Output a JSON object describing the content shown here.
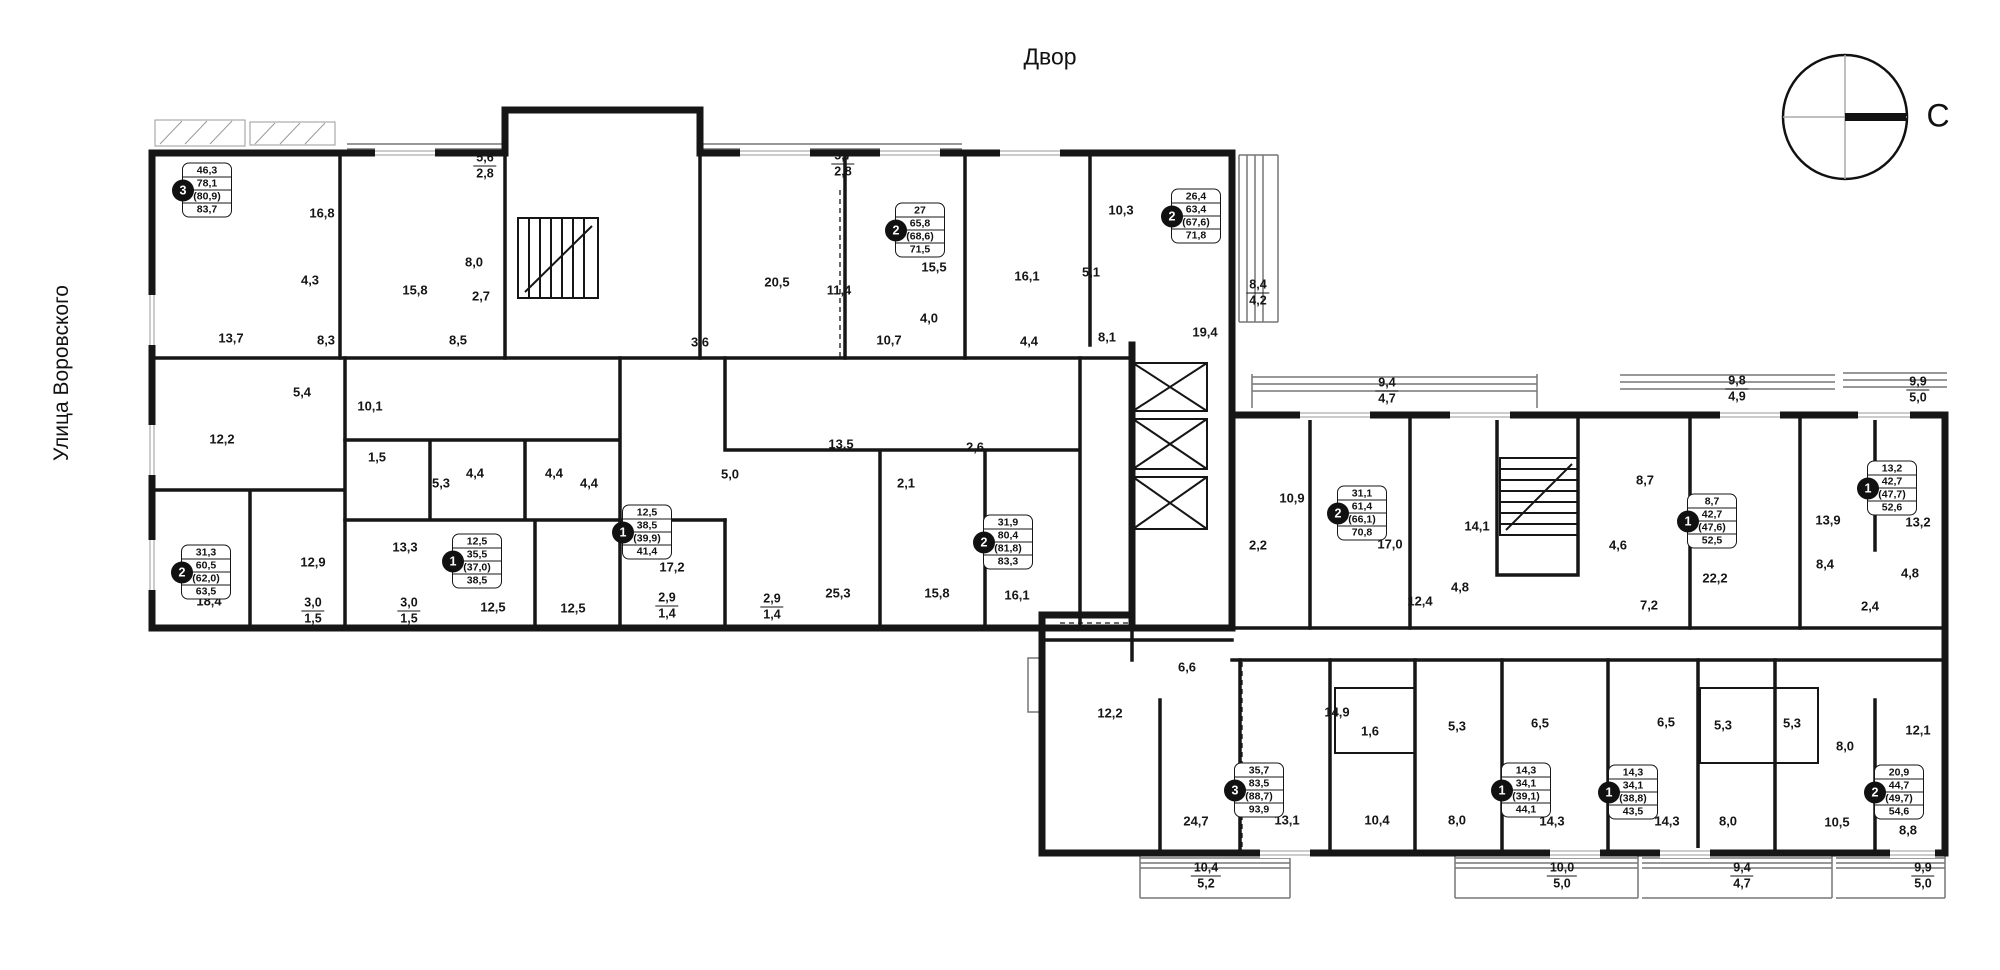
{
  "page": {
    "title": "Двор",
    "street": "Улица Воровского",
    "compass_letter": "С"
  },
  "apartments": [
    {
      "rooms": "3",
      "values": [
        "46,3",
        "78,1",
        "(80,9)",
        "83,7"
      ],
      "x": 207,
      "y": 190
    },
    {
      "rooms": "2",
      "values": [
        "27",
        "65,8",
        "(68,6)",
        "71,5"
      ],
      "x": 920,
      "y": 230
    },
    {
      "rooms": "2",
      "values": [
        "26,4",
        "63,4",
        "(67,6)",
        "71,8"
      ],
      "x": 1196,
      "y": 216
    },
    {
      "rooms": "2",
      "values": [
        "31,3",
        "60,5",
        "(62,0)",
        "63,5"
      ],
      "x": 206,
      "y": 572
    },
    {
      "rooms": "1",
      "values": [
        "12,5",
        "35,5",
        "(37,0)",
        "38,5"
      ],
      "x": 477,
      "y": 561
    },
    {
      "rooms": "1",
      "values": [
        "12,5",
        "38,5",
        "(39,9)",
        "41,4"
      ],
      "x": 647,
      "y": 532
    },
    {
      "rooms": "2",
      "values": [
        "31,9",
        "80,4",
        "(81,8)",
        "83,3"
      ],
      "x": 1008,
      "y": 542
    },
    {
      "rooms": "2",
      "values": [
        "31,1",
        "61,4",
        "(66,1)",
        "70,8"
      ],
      "x": 1362,
      "y": 513
    },
    {
      "rooms": "1",
      "values": [
        "8,7",
        "42,7",
        "(47,6)",
        "52,5"
      ],
      "x": 1712,
      "y": 521
    },
    {
      "rooms": "1",
      "values": [
        "13,2",
        "42,7",
        "(47,7)",
        "52,6"
      ],
      "x": 1892,
      "y": 488
    },
    {
      "rooms": "3",
      "values": [
        "35,7",
        "83,5",
        "(88,7)",
        "93,9"
      ],
      "x": 1259,
      "y": 790
    },
    {
      "rooms": "1",
      "values": [
        "14,3",
        "34,1",
        "(39,1)",
        "44,1"
      ],
      "x": 1526,
      "y": 790
    },
    {
      "rooms": "1",
      "values": [
        "14,3",
        "34,1",
        "(38,8)",
        "43,5"
      ],
      "x": 1633,
      "y": 792
    },
    {
      "rooms": "2",
      "values": [
        "20,9",
        "44,7",
        "(49,7)",
        "54,6"
      ],
      "x": 1899,
      "y": 792
    }
  ],
  "room_dims": [
    {
      "t": "16,8",
      "x": 322,
      "y": 213
    },
    {
      "t": "4,3",
      "x": 310,
      "y": 280
    },
    {
      "t": "15,8",
      "x": 415,
      "y": 290
    },
    {
      "t": "8,0",
      "x": 474,
      "y": 262
    },
    {
      "t": "2,7",
      "x": 481,
      "y": 296
    },
    {
      "t": "13,7",
      "x": 231,
      "y": 338
    },
    {
      "t": "8,3",
      "x": 326,
      "y": 340
    },
    {
      "t": "8,5",
      "x": 458,
      "y": 340
    },
    {
      "t": "3,6",
      "x": 700,
      "y": 342
    },
    {
      "t": "5,4",
      "x": 302,
      "y": 392
    },
    {
      "t": "10,1",
      "x": 370,
      "y": 406
    },
    {
      "t": "12,2",
      "x": 222,
      "y": 439
    },
    {
      "t": "1,5",
      "x": 377,
      "y": 457
    },
    {
      "t": "5,3",
      "x": 441,
      "y": 483
    },
    {
      "t": "4,4",
      "x": 475,
      "y": 473
    },
    {
      "t": "4,4",
      "x": 554,
      "y": 473
    },
    {
      "t": "4,4",
      "x": 589,
      "y": 483
    },
    {
      "t": "13,3",
      "x": 405,
      "y": 547
    },
    {
      "t": "12,9",
      "x": 313,
      "y": 562
    },
    {
      "t": "18,4",
      "x": 209,
      "y": 601
    },
    {
      "t": "12,5",
      "x": 493,
      "y": 607
    },
    {
      "t": "12,5",
      "x": 573,
      "y": 608
    },
    {
      "t": "17,2",
      "x": 672,
      "y": 567
    },
    {
      "t": "5,0",
      "x": 730,
      "y": 474
    },
    {
      "t": "13,5",
      "x": 841,
      "y": 444
    },
    {
      "t": "2,6",
      "x": 975,
      "y": 447
    },
    {
      "t": "2,1",
      "x": 906,
      "y": 483
    },
    {
      "t": "25,3",
      "x": 838,
      "y": 593
    },
    {
      "t": "15,8",
      "x": 937,
      "y": 593
    },
    {
      "t": "16,1",
      "x": 1017,
      "y": 595
    },
    {
      "t": "20,5",
      "x": 777,
      "y": 282
    },
    {
      "t": "11,4",
      "x": 839,
      "y": 290
    },
    {
      "t": "15,5",
      "x": 934,
      "y": 267
    },
    {
      "t": "4,0",
      "x": 929,
      "y": 318
    },
    {
      "t": "10,7",
      "x": 889,
      "y": 340
    },
    {
      "t": "4,4",
      "x": 1029,
      "y": 341
    },
    {
      "t": "16,1",
      "x": 1027,
      "y": 276
    },
    {
      "t": "5,1",
      "x": 1091,
      "y": 272
    },
    {
      "t": "10,3",
      "x": 1121,
      "y": 210
    },
    {
      "t": "8,1",
      "x": 1107,
      "y": 337
    },
    {
      "t": "19,4",
      "x": 1205,
      "y": 332
    },
    {
      "t": "10,9",
      "x": 1292,
      "y": 498
    },
    {
      "t": "2,2",
      "x": 1258,
      "y": 545
    },
    {
      "t": "17,0",
      "x": 1390,
      "y": 544
    },
    {
      "t": "14,1",
      "x": 1477,
      "y": 526
    },
    {
      "t": "12,4",
      "x": 1420,
      "y": 601
    },
    {
      "t": "4,8",
      "x": 1460,
      "y": 587
    },
    {
      "t": "8,7",
      "x": 1645,
      "y": 480
    },
    {
      "t": "4,6",
      "x": 1618,
      "y": 545
    },
    {
      "t": "7,2",
      "x": 1649,
      "y": 605
    },
    {
      "t": "22,2",
      "x": 1715,
      "y": 578
    },
    {
      "t": "13,9",
      "x": 1828,
      "y": 520
    },
    {
      "t": "13,2",
      "x": 1918,
      "y": 522
    },
    {
      "t": "8,4",
      "x": 1825,
      "y": 564
    },
    {
      "t": "4,8",
      "x": 1910,
      "y": 573
    },
    {
      "t": "2,4",
      "x": 1870,
      "y": 606
    },
    {
      "t": "6,6",
      "x": 1187,
      "y": 667
    },
    {
      "t": "12,2",
      "x": 1110,
      "y": 713
    },
    {
      "t": "14,9",
      "x": 1337,
      "y": 712
    },
    {
      "t": "1,6",
      "x": 1370,
      "y": 731
    },
    {
      "t": "5,3",
      "x": 1457,
      "y": 726
    },
    {
      "t": "6,5",
      "x": 1540,
      "y": 723
    },
    {
      "t": "6,5",
      "x": 1666,
      "y": 722
    },
    {
      "t": "5,3",
      "x": 1723,
      "y": 725
    },
    {
      "t": "5,3",
      "x": 1792,
      "y": 723
    },
    {
      "t": "8,0",
      "x": 1845,
      "y": 746
    },
    {
      "t": "12,1",
      "x": 1918,
      "y": 730
    },
    {
      "t": "24,7",
      "x": 1196,
      "y": 821
    },
    {
      "t": "13,1",
      "x": 1287,
      "y": 820
    },
    {
      "t": "10,4",
      "x": 1377,
      "y": 820
    },
    {
      "t": "8,0",
      "x": 1457,
      "y": 820
    },
    {
      "t": "14,3",
      "x": 1552,
      "y": 821
    },
    {
      "t": "14,3",
      "x": 1667,
      "y": 821
    },
    {
      "t": "8,0",
      "x": 1728,
      "y": 821
    },
    {
      "t": "10,5",
      "x": 1837,
      "y": 822
    },
    {
      "t": "8,8",
      "x": 1908,
      "y": 830
    }
  ],
  "fraction_dims": [
    {
      "top": "5,6",
      "bottom": "2,8",
      "x": 485,
      "y": 166
    },
    {
      "top": "5,7",
      "bottom": "2,8",
      "x": 843,
      "y": 164
    },
    {
      "top": "8,4",
      "bottom": "4,2",
      "x": 1258,
      "y": 293
    },
    {
      "top": "9,4",
      "bottom": "4,7",
      "x": 1387,
      "y": 391
    },
    {
      "top": "9,8",
      "bottom": "4,9",
      "x": 1737,
      "y": 389
    },
    {
      "top": "9,9",
      "bottom": "5,0",
      "x": 1918,
      "y": 390
    },
    {
      "top": "3,0",
      "bottom": "1,5",
      "x": 313,
      "y": 611
    },
    {
      "top": "3,0",
      "bottom": "1,5",
      "x": 409,
      "y": 611
    },
    {
      "top": "2,9",
      "bottom": "1,4",
      "x": 667,
      "y": 606
    },
    {
      "top": "2,9",
      "bottom": "1,4",
      "x": 772,
      "y": 607
    },
    {
      "top": "10,4",
      "bottom": "5,2",
      "x": 1206,
      "y": 876
    },
    {
      "top": "10,0",
      "bottom": "5,0",
      "x": 1562,
      "y": 876
    },
    {
      "top": "9,4",
      "bottom": "4,7",
      "x": 1742,
      "y": 876
    },
    {
      "top": "9,9",
      "bottom": "5,0",
      "x": 1923,
      "y": 876
    }
  ]
}
